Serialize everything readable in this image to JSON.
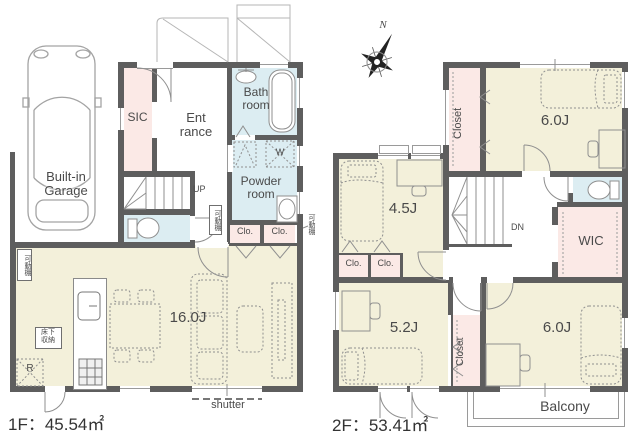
{
  "palette": {
    "room_beige": "#f3f0da",
    "wet_blue": "#dcedf2",
    "storage_pink": "#fbe9e6",
    "wall_gray": "#5e5e5e",
    "line_gray": "#9a9a9a",
    "text_gray": "#4a4a4a"
  },
  "floor1": {
    "area_label": "1F：45.54㎡",
    "garage_label": "Built-in\nGarage",
    "sic_label": "SIC",
    "entrance_label": "Ent\nrance",
    "bath_label": "Bath\nroom",
    "powder_label": "Powder\nroom",
    "washer_label": "W",
    "fridge_label": "R",
    "underfloor_label": "床下\n収納",
    "shelf_label": "可動棚",
    "closet_label": "Clo.",
    "ldk_label": "16.0J",
    "up_label": "UP",
    "shutter_label": "shutter"
  },
  "floor2": {
    "area_label": "2F：53.41㎡",
    "compass_label": "N",
    "room_6a_label": "6.0J",
    "room_45_label": "4.5J",
    "room_52_label": "5.2J",
    "room_6b_label": "6.0J",
    "closet_vertical_label": "Closet",
    "closet_label": "Clo.",
    "wic_label": "WIC",
    "dn_label": "DN",
    "balcony_label": "Balcony"
  }
}
